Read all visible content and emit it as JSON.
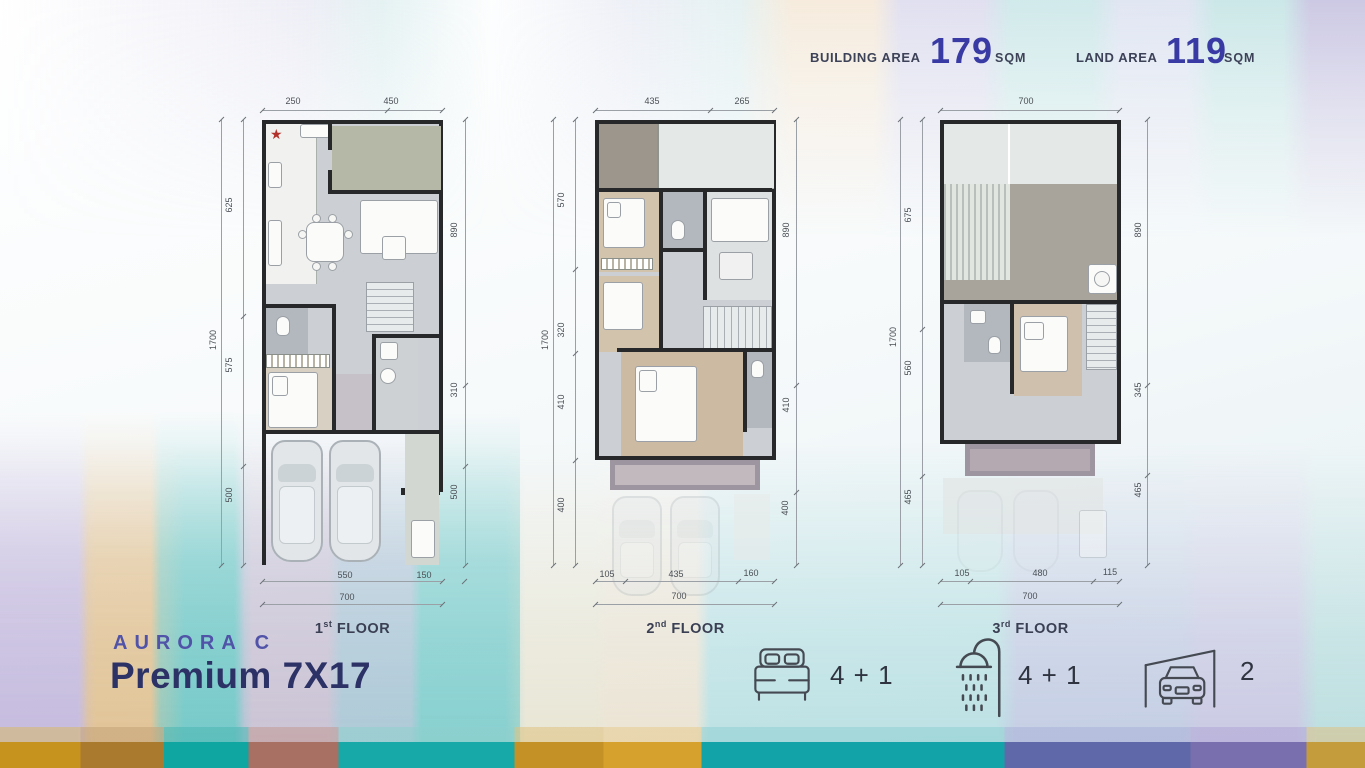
{
  "header": {
    "building_area_label": "BUILDING AREA",
    "building_area_value": "179",
    "building_area_unit": "SQM",
    "land_area_label": "LAND AREA",
    "land_area_value": "119",
    "land_area_unit": "SQM"
  },
  "title": {
    "series": "AURORA C",
    "model": "Premium 7X17"
  },
  "floors": [
    {
      "label": {
        "num": "1",
        "ord": "st",
        "word": " FLOOR"
      },
      "marker": "★",
      "top": [
        "250",
        "450"
      ],
      "left": [
        "625",
        "575",
        "500"
      ],
      "left_overall": "1700",
      "right": [
        "890",
        "310",
        "500"
      ],
      "bottom": [
        "550",
        "150"
      ],
      "bottom_overall": "700"
    },
    {
      "label": {
        "num": "2",
        "ord": "nd",
        "word": " FLOOR"
      },
      "top": [
        "435",
        "265"
      ],
      "left": [
        "570",
        "320",
        "410",
        "400"
      ],
      "left_overall": "1700",
      "right": [
        "890",
        "410",
        "400"
      ],
      "bottom": [
        "105",
        "435",
        "160"
      ],
      "bottom_overall": "700"
    },
    {
      "label": {
        "num": "3",
        "ord": "rd",
        "word": " FLOOR"
      },
      "top": [
        "700"
      ],
      "left": [
        "675",
        "560",
        "465"
      ],
      "left_overall": "1700",
      "right": [
        "890",
        "345",
        "465"
      ],
      "bottom": [
        "105",
        "480",
        "115"
      ],
      "bottom_overall": "700"
    }
  ],
  "stats": [
    {
      "name": "bedrooms",
      "icon": "bed-icon",
      "value": "4 + 1"
    },
    {
      "name": "bathrooms",
      "icon": "shower-icon",
      "value": "4 + 1"
    },
    {
      "name": "carport",
      "icon": "car-garage-icon",
      "value": "2"
    }
  ],
  "colors": {
    "area_number": "#393aa3",
    "series_title": "#5053a8",
    "model_title": "#2c3166",
    "dark_text": "#3d4258",
    "bottom_band_teal": "#12a3a9",
    "bottom_band_gold": "#c7931f",
    "bottom_band_indigo": "#5f68a8"
  }
}
